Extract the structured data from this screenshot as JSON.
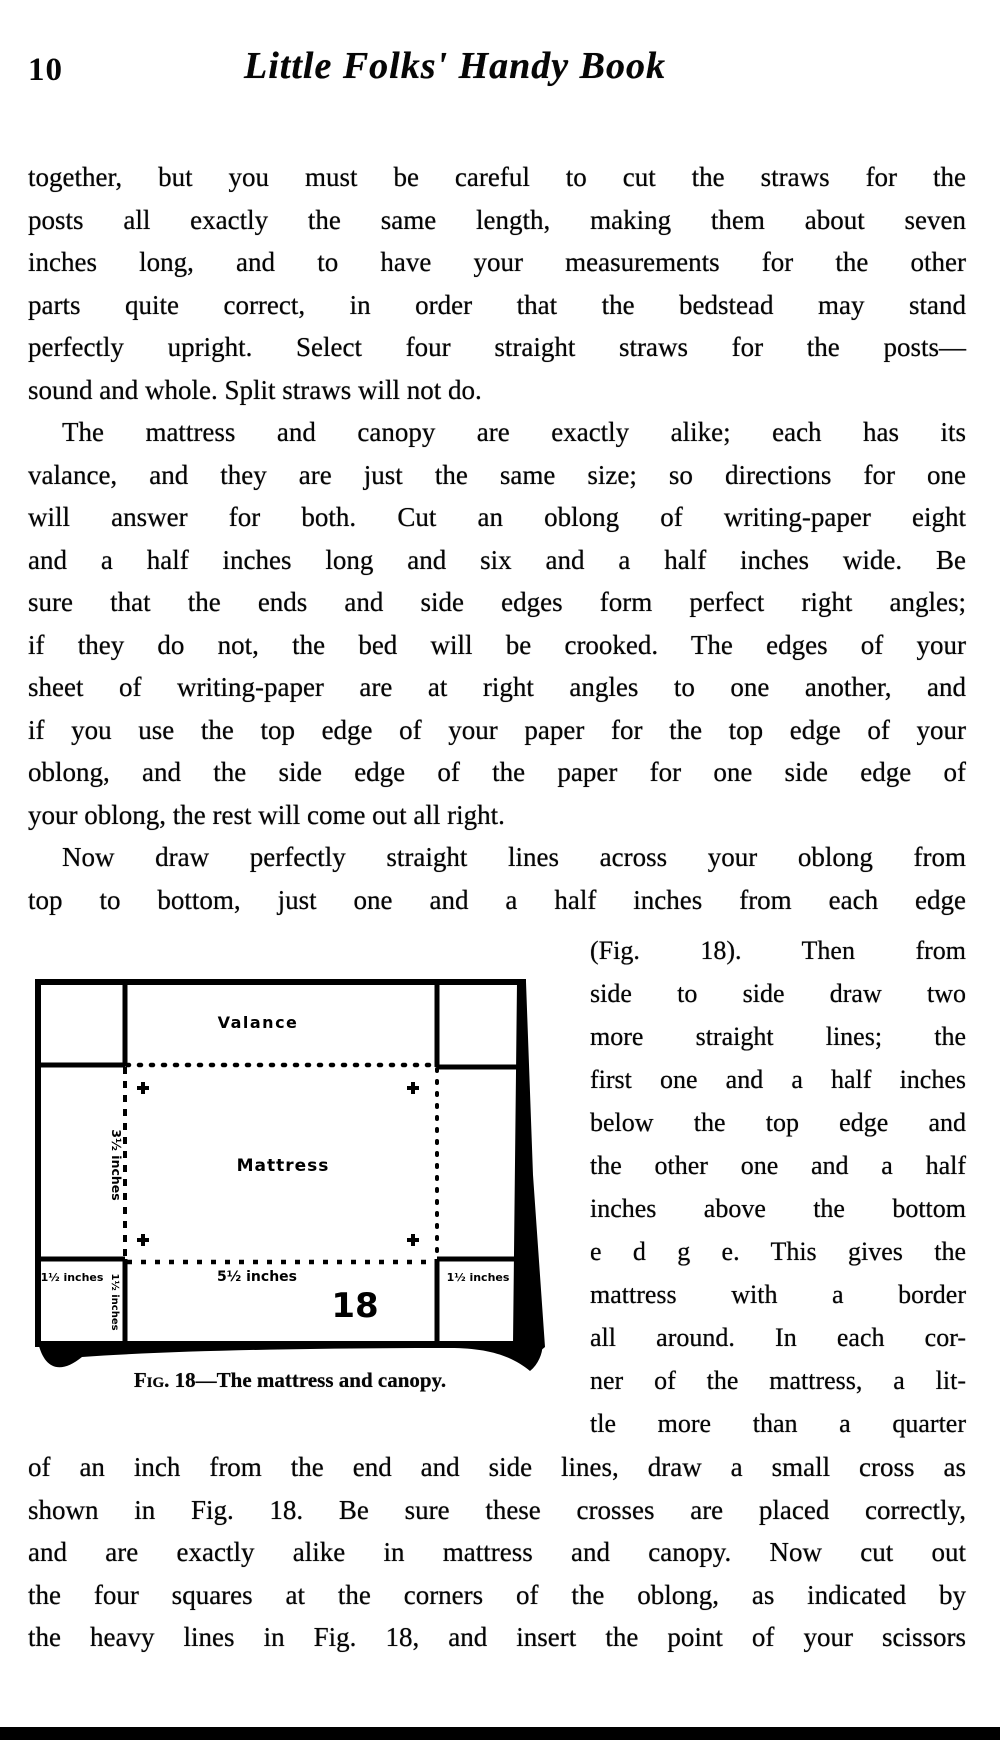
{
  "page": {
    "number": "10",
    "title": "Little Folks' Handy Book"
  },
  "paragraphs": {
    "top_lines": [
      {
        "text": "together, but you must be careful to cut the straws for the"
      },
      {
        "text": "posts all exactly the same length, making them about seven"
      },
      {
        "text": "inches long, and to have your measurements for the other"
      },
      {
        "text": "parts quite correct, in order that the bedstead may stand"
      },
      {
        "text": "perfectly upright.  Select four straight straws for the posts—"
      },
      {
        "text": "sound and whole.  Split straws will not do.",
        "end": true
      },
      {
        "text": "The mattress and canopy are exactly alike;  each has its",
        "indent": true
      },
      {
        "text": "valance, and they are just the same size;  so directions for one"
      },
      {
        "text": "will answer for both.  Cut an oblong of writing-paper eight"
      },
      {
        "text": "and a half inches long and six and a half inches wide.  Be"
      },
      {
        "text": "sure that the ends and side edges form perfect right angles;"
      },
      {
        "text": "if they do not, the bed will be crooked.  The edges of your"
      },
      {
        "text": "sheet of writing-paper are at right angles to one another, and"
      },
      {
        "text": "if you use the top edge of your paper for the top edge of your"
      },
      {
        "text": "oblong, and the side edge of the paper for one side edge of"
      },
      {
        "text": "your oblong, the rest will come out all right.",
        "end": true
      },
      {
        "text": "Now draw perfectly straight lines across your oblong from",
        "indent": true
      },
      {
        "text": "top to bottom, just one and a half inches from each edge"
      }
    ],
    "right_lines": [
      {
        "text": "(Fig. 18).  Then from"
      },
      {
        "text": "side to side draw two"
      },
      {
        "text": "more straight lines; the"
      },
      {
        "text": "first one and a half inches"
      },
      {
        "text": "below the top edge and"
      },
      {
        "text": "the other one and a half"
      },
      {
        "text": "inches above the bottom"
      },
      {
        "text": "e d g e.  This gives the"
      },
      {
        "text": "mattress with a border"
      },
      {
        "text": "all around.  In each cor-"
      },
      {
        "text": "ner of the mattress, a lit-"
      },
      {
        "text": "tle more than a quarter"
      }
    ],
    "bottom_lines": [
      {
        "text": "of an inch from the end and side lines, draw a small cross as"
      },
      {
        "text": "shown in Fig. 18.  Be sure these crosses are placed correctly,"
      },
      {
        "text": "and are exactly alike in mattress and canopy.  Now cut out"
      },
      {
        "text": "the four squares at the corners of the oblong, as indicated by"
      },
      {
        "text": "the heavy lines in Fig. 18, and insert the point of your scissors"
      }
    ]
  },
  "figure": {
    "valance_label": "Valance",
    "mattress_label": "Mattress",
    "left_dim": "3½ inches",
    "bottom_dim": "5½ inches",
    "corner_dim_bottom_left": "1½ inches",
    "corner_dim_bottom_left_vertical": "1½ inches",
    "corner_dim_bottom_right": "1½ inches",
    "figure_number": "18",
    "caption_fig": "Fig.",
    "caption_rest": " 18—The mattress and canopy."
  },
  "colors": {
    "ink": "#000000",
    "paper": "#ffffff"
  }
}
